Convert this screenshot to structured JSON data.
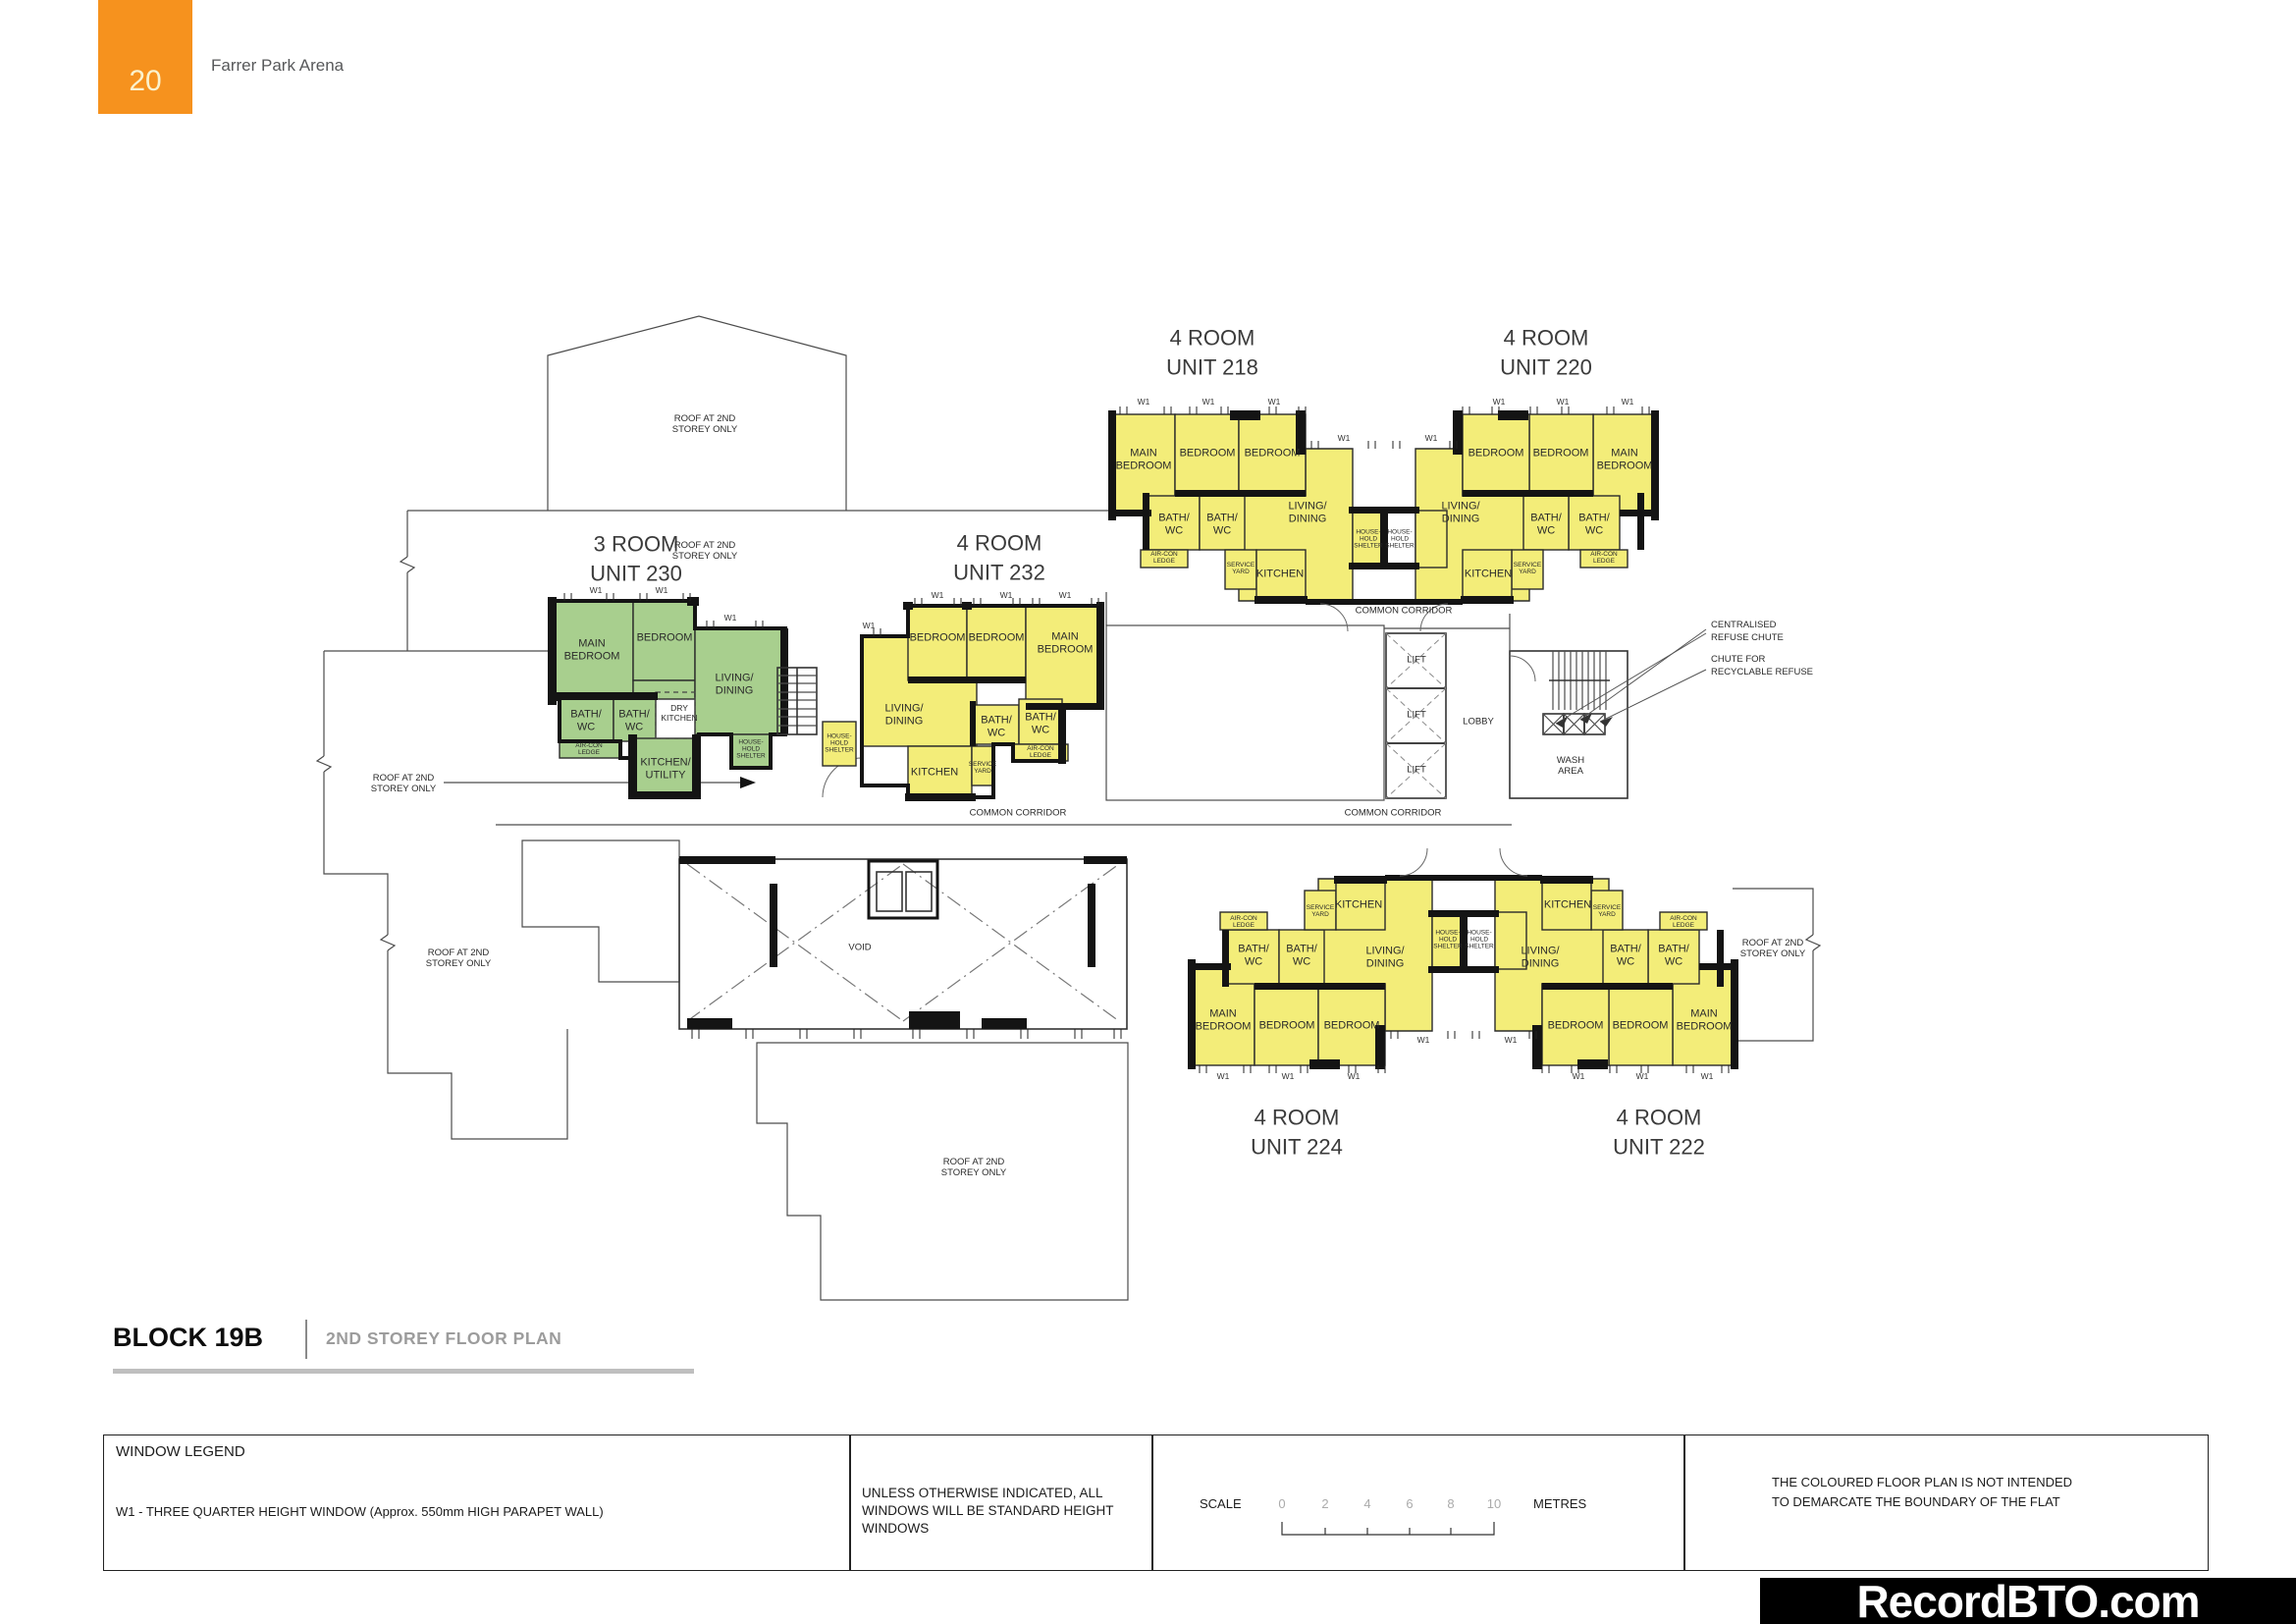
{
  "page": {
    "number": "20",
    "project": "Farrer Park Arena"
  },
  "plan": {
    "units": [
      {
        "id": "218",
        "type": "4 ROOM",
        "name": "UNIT 218"
      },
      {
        "id": "220",
        "type": "4 ROOM",
        "name": "UNIT 220"
      },
      {
        "id": "230",
        "type": "3 ROOM",
        "name": "UNIT 230"
      },
      {
        "id": "232",
        "type": "4 ROOM",
        "name": "UNIT 232"
      },
      {
        "id": "224",
        "type": "4 ROOM",
        "name": "UNIT 224"
      },
      {
        "id": "222",
        "type": "4 ROOM",
        "name": "UNIT 222"
      }
    ],
    "rooms": {
      "main_bedroom": "MAIN\nBEDROOM",
      "bedroom": "BEDROOM",
      "living_dining": "LIVING/\nDINING",
      "bath_wc": "BATH/\nWC",
      "kitchen": "KITCHEN",
      "kitchen_utility": "KITCHEN/\nUTILITY",
      "dry_kitchen": "DRY\nKITCHEN",
      "service_yard": "SERVICE\nYARD",
      "aircon_ledge": "AIR-CON\nLEDGE",
      "household_shelter": "HOUSE-\nHOLD\nSHELTER"
    },
    "areas": {
      "common_corridor": "COMMON CORRIDOR",
      "lift": "LIFT",
      "lobby": "LOBBY",
      "wash_area": "WASH\nAREA",
      "void": "VOID",
      "roof_note": "ROOF AT 2ND\nSTOREY ONLY",
      "window_tag": "W1"
    },
    "annotations": {
      "refuse_chute": "CENTRALISED\nREFUSE CHUTE",
      "recyclable_chute": "CHUTE FOR\nRECYCLABLE REFUSE"
    },
    "colors": {
      "four_room_fill": "#F3ED79",
      "three_room_fill": "#A8CF8E"
    }
  },
  "title": {
    "block": "BLOCK 19B",
    "plan": "2ND STOREY FLOOR PLAN"
  },
  "legend": {
    "window": {
      "heading": "WINDOW LEGEND",
      "w1": "W1 - THREE QUARTER HEIGHT WINDOW (Approx. 550mm HIGH PARAPET WALL)"
    },
    "windows_note": "UNLESS OTHERWISE INDICATED, ALL\nWINDOWS WILL BE STANDARD HEIGHT\nWINDOWS",
    "scale": {
      "label": "SCALE",
      "ticks": [
        "0",
        "2",
        "4",
        "6",
        "8",
        "10"
      ],
      "unit": "METRES"
    },
    "boundary_note": "THE COLOURED FLOOR PLAN IS NOT INTENDED\nTO DEMARCATE THE BOUNDARY OF THE FLAT"
  },
  "watermark": "RecordBTO.com",
  "theme": {
    "accent_orange": "#F6921E",
    "banner_bg": "#000000"
  }
}
